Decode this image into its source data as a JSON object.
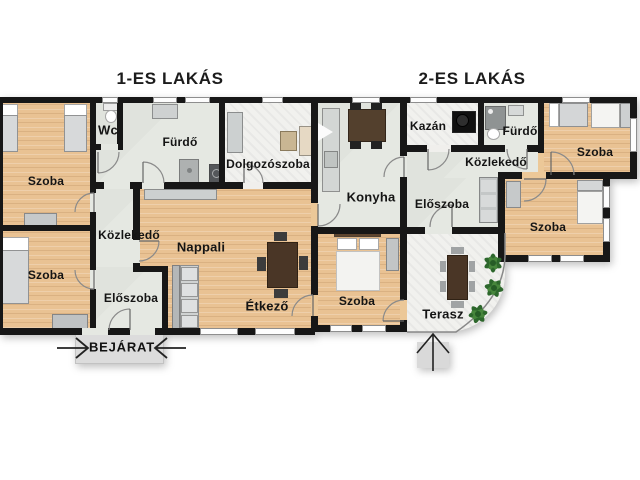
{
  "titles": {
    "apartment1": "1-ES LAKÁS",
    "apartment2": "2-ES LAKÁS"
  },
  "rooms": {
    "szoba_top_left": "Szoba",
    "szoba_bottom_left": "Szoba",
    "wc": "Wc",
    "furdo1": "Fürdő",
    "dolgozoszoba": "Dolgozószoba",
    "kozlekedo1": "Közlekedő",
    "eloszoba1": "Előszoba",
    "nappali": "Nappali",
    "etkezo": "Étkező",
    "konyha": "Konyha",
    "kazan": "Kazán",
    "furdo2": "Fürdő",
    "kozlekedo2": "Közlekedő",
    "eloszoba2": "Előszoba",
    "szoba_top_right": "Szoba",
    "szoba_mid_right": "Szoba",
    "szoba_bottom_mid": "Szoba",
    "terasz": "Terasz"
  },
  "entrance": {
    "label": "BEJÁRAT"
  },
  "colors": {
    "wall": "#171717",
    "wood_floor": "#e9c293",
    "tile_floor": "#e5e8e2",
    "marble_floor": "#f1f1ee",
    "plant_green": "#2d672c",
    "table_brown": "#4a3626"
  }
}
